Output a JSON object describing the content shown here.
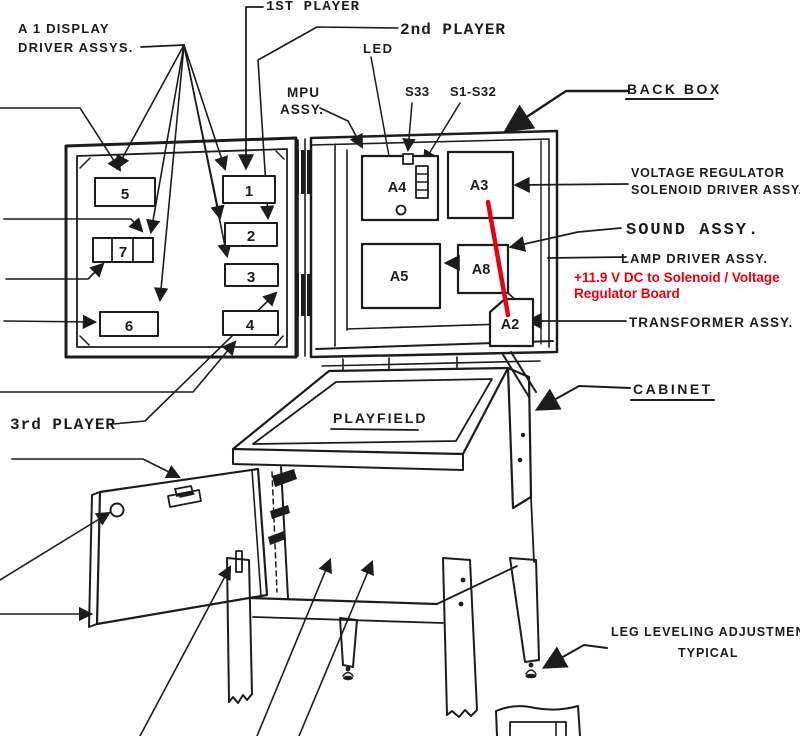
{
  "labels": {
    "a1_display_1": "A 1 DISPLAY",
    "a1_display_2": "DRIVER  ASSYS.",
    "first_player": "1ST PLAYER",
    "second_player": "2nd PLAYER",
    "third_player": "3rd PLAYER",
    "led": "LED",
    "mpu_1": "MPU",
    "mpu_2": "ASSY.",
    "s33": "S33",
    "s1_s32": "S1-S32",
    "back_box": "BACK BOX",
    "voltage_regulator_1": "VOLTAGE REGULATOR",
    "voltage_regulator_2": "SOLENOID DRIVER ASSY.",
    "sound": "SOUND ASSY.",
    "lamp_driver": "LAMP DRIVER ASSY.",
    "transformer": "TRANSFORMER  ASSY.",
    "cabinet": "CABINET",
    "playfield": "PLAYFIELD",
    "leg_leveling_1": "LEG LEVELING ADJUSTMENT",
    "leg_leveling_2": "TYPICAL"
  },
  "annotation": {
    "line1": "+11.9 V DC to Solenoid / Voltage",
    "line2": "Regulator Board",
    "color": "#e8000d"
  },
  "boards": {
    "b1": "1",
    "b2": "2",
    "b3": "3",
    "b4": "4",
    "b5": "5",
    "b6": "6",
    "b7": "7",
    "a2": "A2",
    "a3": "A3",
    "a4": "A4",
    "a5": "A5",
    "a8": "A8"
  },
  "colors": {
    "ink": "#1c1c1c",
    "paper": "#fefefe",
    "annotation_red": "#e8000d"
  }
}
